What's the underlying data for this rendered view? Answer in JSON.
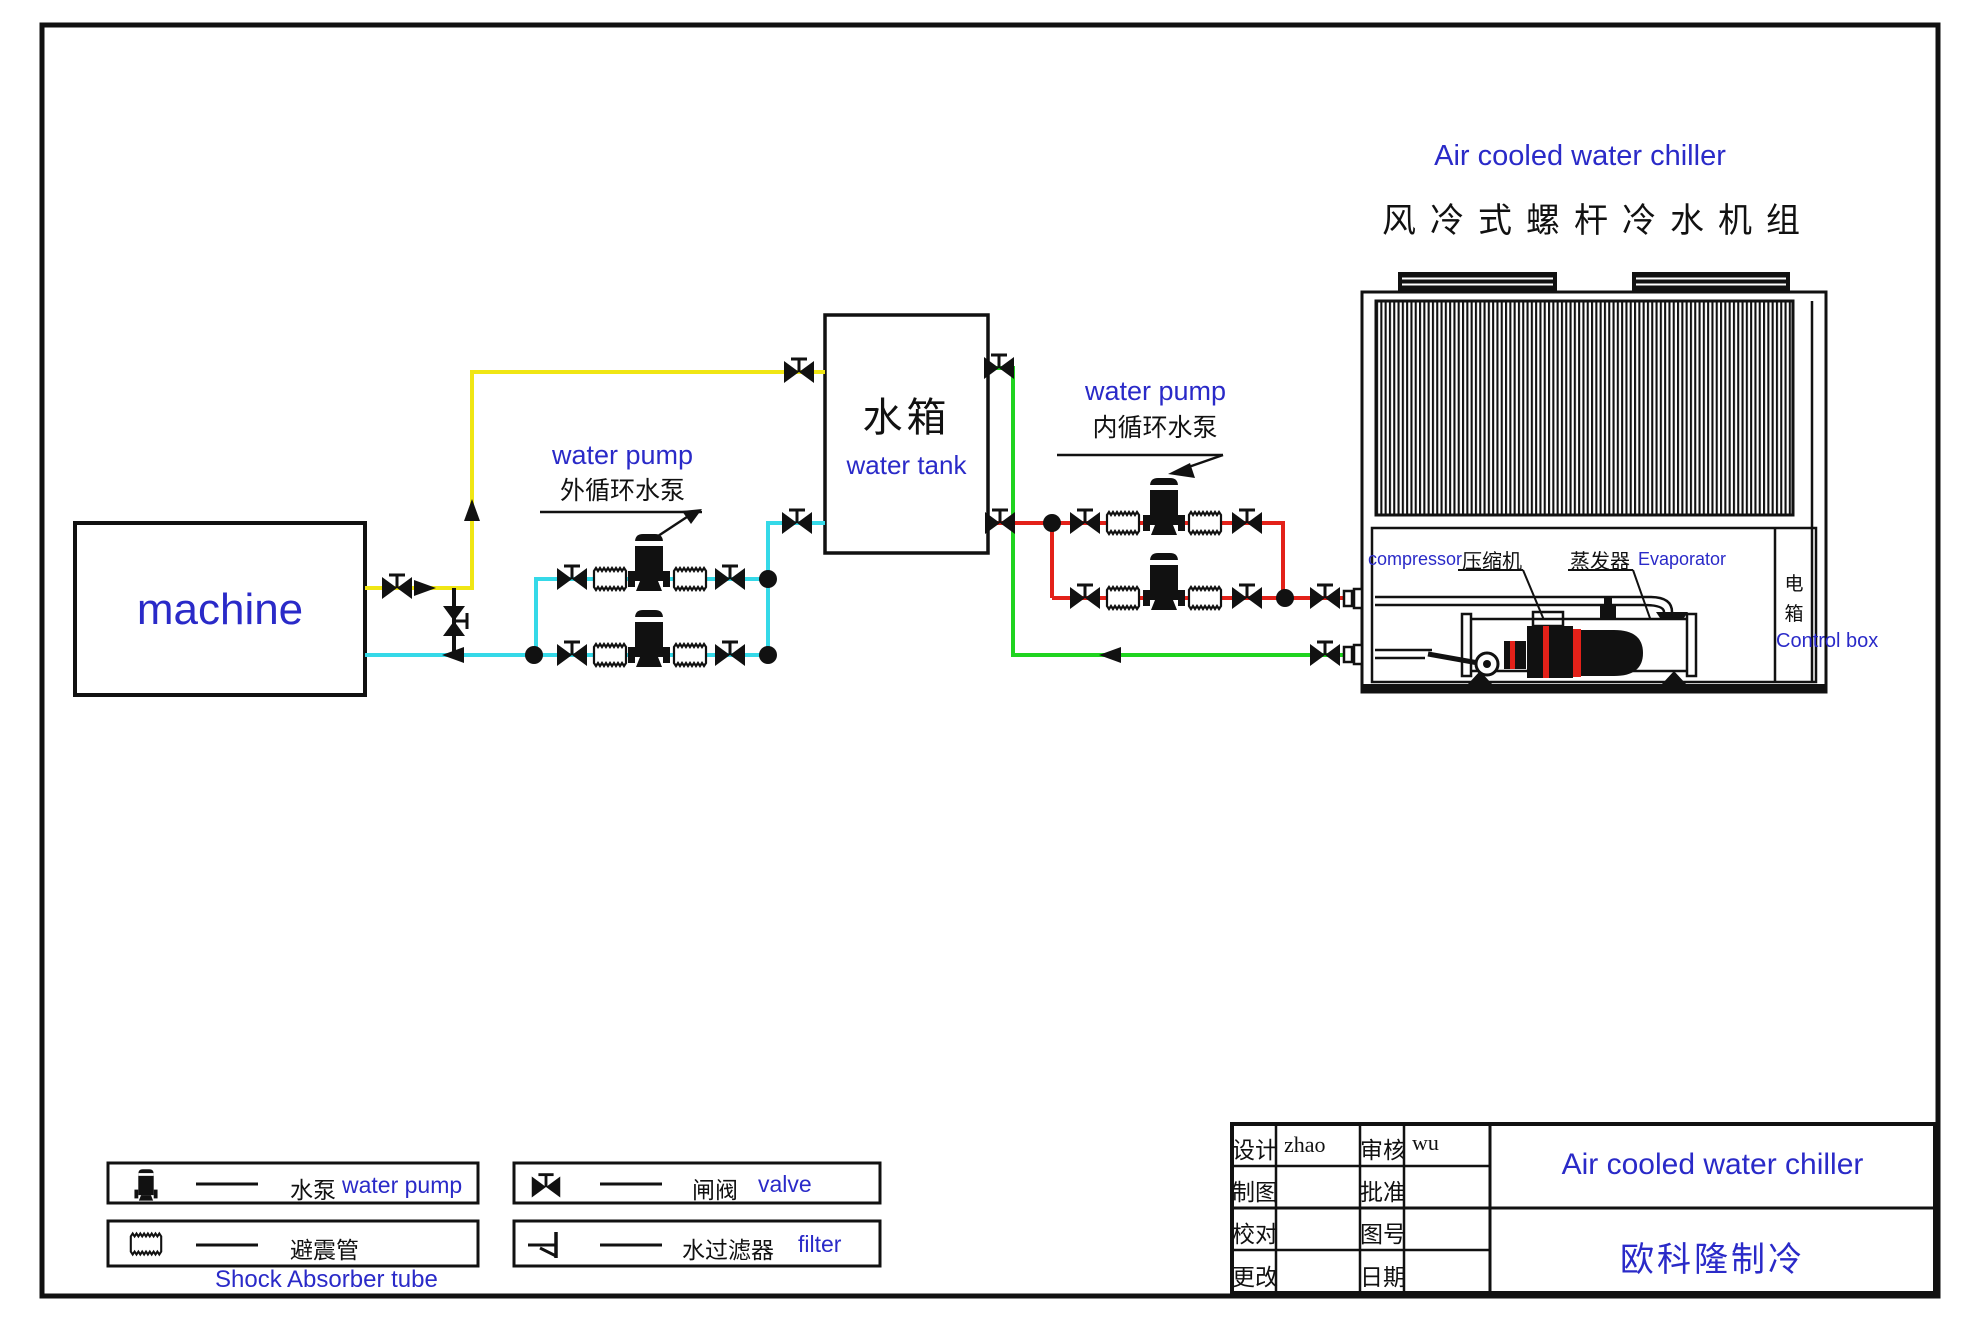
{
  "colors": {
    "blue": "#2a2ac8",
    "yellow": "#f0e614",
    "cyan": "#35d9e8",
    "green": "#1fd41f",
    "red": "#e32119",
    "black": "#111111"
  },
  "title": {
    "en": "Air cooled water chiller",
    "zh": "风冷式螺杆冷水机组"
  },
  "machine": {
    "label": "machine"
  },
  "water_tank": {
    "zh": "水箱",
    "en": "water tank"
  },
  "external_pump": {
    "en": "water pump",
    "zh": "外循环水泵"
  },
  "internal_pump": {
    "en": "water pump",
    "zh": "内循环水泵"
  },
  "chiller": {
    "compressor_en": "compressor",
    "compressor_zh": "压缩机",
    "evaporator_zh": "蒸发器",
    "evaporator_en": "Evaporator",
    "control_zh": "电箱",
    "control_en": "Control box"
  },
  "legend": {
    "items": [
      {
        "name": "water-pump",
        "zh": "水泵",
        "en": "water pump"
      },
      {
        "name": "shock-absorber-tube",
        "zh": "避震管",
        "en": "Shock Absorber tube"
      },
      {
        "name": "valve",
        "zh": "闸阀",
        "en": "valve"
      },
      {
        "name": "filter",
        "zh": "水过滤器",
        "en": "filter"
      }
    ]
  },
  "title_block": {
    "rows": [
      {
        "l1": "设计",
        "v1": "zhao",
        "l2": "审核",
        "v2": "wu"
      },
      {
        "l1": "制图",
        "v1": "",
        "l2": "批准",
        "v2": ""
      },
      {
        "l1": "校对",
        "v1": "",
        "l2": "图号",
        "v2": ""
      },
      {
        "l1": "更改",
        "v1": "",
        "l2": "日期",
        "v2": ""
      }
    ],
    "product": "Air cooled water chiller",
    "company": "欧科隆制冷"
  }
}
